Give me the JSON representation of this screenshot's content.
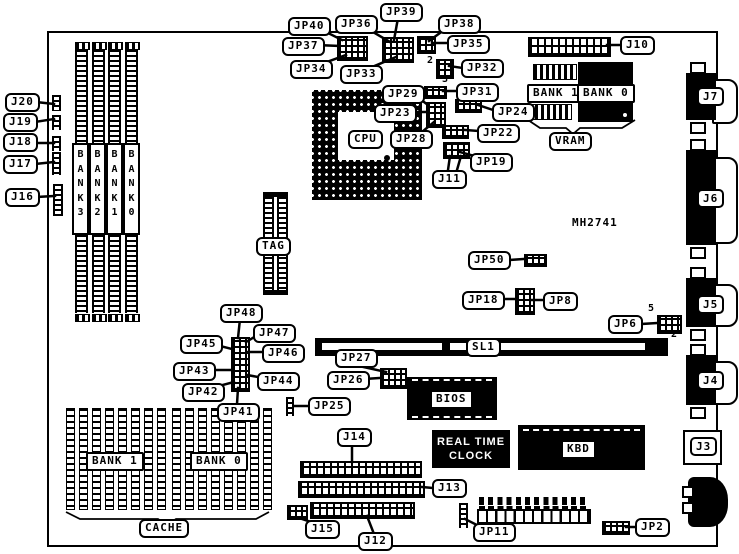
{
  "diagram": {
    "part_number": "MH2741"
  },
  "labels": {
    "j20": "J20",
    "j19": "J19",
    "j18": "J18",
    "j17": "J17",
    "j16": "J16",
    "jp40": "JP40",
    "jp37": "JP37",
    "jp34": "JP34",
    "jp36": "JP36",
    "jp39": "JP39",
    "jp33": "JP33",
    "jp38": "JP38",
    "jp35": "JP35",
    "jp32": "JP32",
    "jp31": "JP31",
    "jp29": "JP29",
    "jp23": "JP23",
    "jp28": "JP28",
    "jp24": "JP24",
    "jp22": "JP22",
    "jp19": "JP19",
    "j11": "J11",
    "j10": "J10",
    "cpu": "CPU",
    "tag": "TAG",
    "vram_bank1": "BANK 1",
    "vram_bank0": "BANK 0",
    "vram": "VRAM",
    "simm_bank3": "BANK 3",
    "simm_bank2": "BANK 2",
    "simm_bank1": "BANK 1",
    "simm_bank0": "BANK 0",
    "j7": "J7",
    "j6": "J6",
    "j5": "J5",
    "j4": "J4",
    "j3": "J3",
    "jp50": "JP50",
    "jp18": "JP18",
    "jp8": "JP8",
    "jp6": "JP6",
    "jp48": "JP48",
    "jp47": "JP47",
    "jp45": "JP45",
    "jp46": "JP46",
    "jp43": "JP43",
    "jp44": "JP44",
    "jp42": "JP42",
    "jp41": "JP41",
    "sl1": "SL1",
    "jp27": "JP27",
    "jp26": "JP26",
    "jp25": "JP25",
    "bios": "BIOS",
    "cache_bank1": "BANK 1",
    "cache_bank0": "BANK 0",
    "cache": "CACHE",
    "j14": "J14",
    "j13": "J13",
    "j12": "J12",
    "j15": "J15",
    "rtc_line1": "REAL TIME",
    "rtc_line2": "CLOCK",
    "kbd": "KBD",
    "jp11": "JP11",
    "jp2": "JP2"
  },
  "pin_numbers": {
    "jp32_top": "2",
    "jp32_bottom": "3",
    "jp6_top": "5",
    "jp6_bottom": "2"
  },
  "colors": {
    "background": "#ffffff",
    "outline": "#000000",
    "chip_fill": "#000000"
  }
}
